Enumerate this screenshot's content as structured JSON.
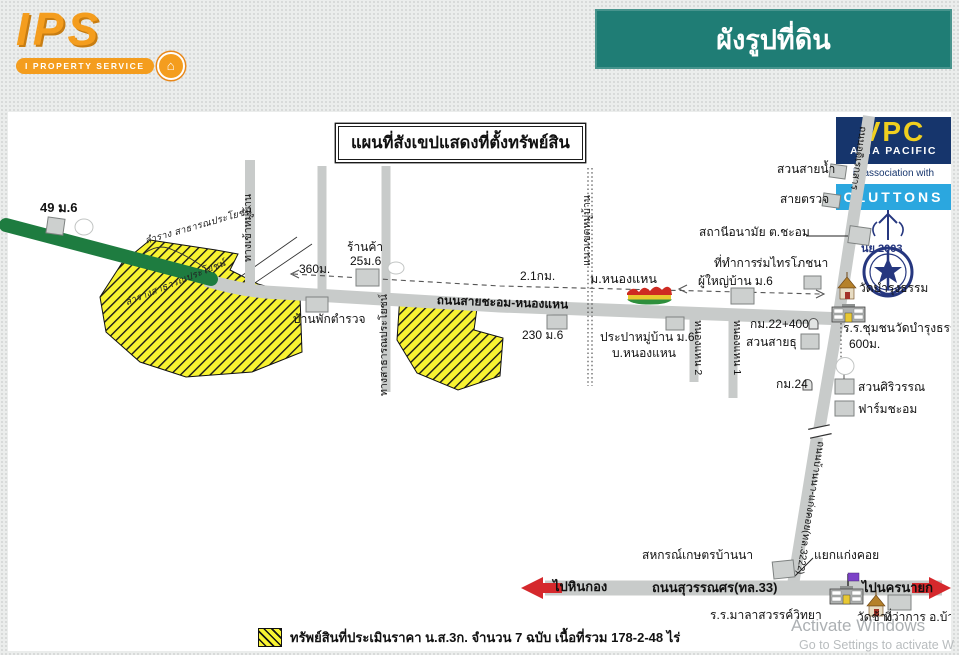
{
  "header": {
    "logo": {
      "brand": "IPS",
      "tagline": "I PROPERTY SERVICE",
      "badge_glyph": "⌂"
    },
    "banner": {
      "title": "ผังรูปที่ดิน",
      "bg": "#1F7D75"
    }
  },
  "vpc": {
    "brand": "VPC",
    "subtitle": "ASIA PACIFIC",
    "association": "in association with",
    "partner": "CLUTTONS"
  },
  "map": {
    "title": "แผนที่สังเขปแสดงที่ตั้งทรัพย์สิน",
    "labels": [
      {
        "text": "49 ม.6",
        "x": 40,
        "y": 201,
        "fs": 13,
        "b": 1,
        "name": "place-label"
      },
      {
        "text": "ลำราง สาธารณประโยชน์",
        "x": 144,
        "y": 237,
        "rot": -16,
        "cls": "hand",
        "name": "ditch-label"
      },
      {
        "text": "ลำรางสาธารณประโยชน์",
        "x": 124,
        "y": 299,
        "rot": -22,
        "cls": "hand",
        "name": "ditch-label"
      },
      {
        "text": "360ม.",
        "x": 299,
        "y": 263,
        "name": "distance-label"
      },
      {
        "text": "ร้านค้า",
        "x": 347,
        "y": 241,
        "name": "place-label"
      },
      {
        "text": "25ม.6",
        "x": 350,
        "y": 255,
        "name": "place-label"
      },
      {
        "text": "บ้านพักตำรวจ",
        "x": 293,
        "y": 313,
        "name": "place-label"
      },
      {
        "text": "2.1กม.",
        "x": 520,
        "y": 270,
        "name": "distance-label"
      },
      {
        "text": "230 ม.6",
        "x": 522,
        "y": 329,
        "name": "place-label"
      },
      {
        "text": "ม.หนองแหน",
        "x": 590,
        "y": 272,
        "fs": 12.5,
        "name": "place-label"
      },
      {
        "text": "ประปาหมู่บ้าน ม.6",
        "x": 600,
        "y": 331,
        "name": "place-label"
      },
      {
        "text": "บ.หนองแหน",
        "x": 612,
        "y": 347,
        "name": "place-label"
      },
      {
        "text": "สวนสายน้ำ",
        "x": 777,
        "y": 163,
        "name": "place-label"
      },
      {
        "text": "สายตรวจ",
        "x": 780,
        "y": 193,
        "name": "place-label"
      },
      {
        "text": "สถานีอนามัย ต.ชะอม",
        "x": 699,
        "y": 226,
        "name": "place-label"
      },
      {
        "text": "ที่ทำการ",
        "x": 714,
        "y": 257,
        "name": "place-label"
      },
      {
        "text": "ผู้ใหญ่บ้าน ม.6",
        "x": 698,
        "y": 275,
        "name": "place-label"
      },
      {
        "text": "ร่มไทรโภชนา",
        "x": 756,
        "y": 257,
        "name": "place-label"
      },
      {
        "text": "นย 2003",
        "x": 861,
        "y": 243,
        "fs": 11,
        "b": 1,
        "c": "#26377F",
        "name": "emblem-label"
      },
      {
        "text": "วัดบำรุงธรรม",
        "x": 859,
        "y": 282,
        "name": "place-label"
      },
      {
        "text": "กม.22+400",
        "x": 750,
        "y": 318,
        "name": "distance-label"
      },
      {
        "text": "สวนสายธุ",
        "x": 746,
        "y": 336,
        "name": "place-label"
      },
      {
        "text": "ร.ร.ชุมชนวัดบำรุงธรรม",
        "x": 843,
        "y": 322,
        "name": "place-label"
      },
      {
        "text": "600ม.",
        "x": 849,
        "y": 338,
        "name": "distance-label"
      },
      {
        "text": "กม.24",
        "x": 776,
        "y": 378,
        "name": "distance-label"
      },
      {
        "text": "สวนศิริวรรณ",
        "x": 858,
        "y": 381,
        "name": "place-label"
      },
      {
        "text": "ฟาร์มชะอม",
        "x": 858,
        "y": 403,
        "name": "place-label"
      },
      {
        "text": "สหกรณ์เกษตรบ้านนา",
        "x": 642,
        "y": 549,
        "name": "place-label"
      },
      {
        "text": "แยกแก่งคอย",
        "x": 814,
        "y": 549,
        "name": "place-label"
      },
      {
        "text": "ไปหินกอง",
        "x": 553,
        "y": 580,
        "fs": 13,
        "b": 1,
        "name": "direction-label"
      },
      {
        "text": "ถนนสุวรรณศร(ทล.33)",
        "x": 652,
        "y": 581,
        "fs": 13,
        "b": 1,
        "name": "road-label"
      },
      {
        "text": "ไปนครนายก",
        "x": 862,
        "y": 581,
        "fs": 13,
        "b": 1,
        "name": "direction-label"
      },
      {
        "text": "ร.ร.มาลาสวรรค์วิทยา",
        "x": 710,
        "y": 609,
        "name": "place-label"
      },
      {
        "text": "วัดช้าง",
        "x": 857,
        "y": 611,
        "name": "place-label"
      },
      {
        "text": "ที่ว่าการ อ.บ้านนา",
        "x": 884,
        "y": 611,
        "name": "place-label"
      },
      {
        "text": "ถนนสายชะอม-หนองแหน",
        "x": 437,
        "y": 294,
        "b": 1,
        "rot": 2,
        "name": "road-label"
      },
      {
        "text": "ทางเข้าหมู่บ้าน",
        "x": 243,
        "y": 262,
        "fs": 10.5,
        "rot": -90,
        "name": "road-label"
      },
      {
        "text": "ทางสาธารณประโยชน์",
        "x": 379,
        "y": 396,
        "fs": 10.5,
        "rot": -90,
        "name": "road-label"
      },
      {
        "text": "แนวเขตหมู่บ้าน",
        "x": 582,
        "y": 266,
        "fs": 10.5,
        "rot": -90,
        "name": "boundary-label"
      },
      {
        "text": "หนองแหน 2",
        "x": 703,
        "y": 320,
        "fs": 10.5,
        "rot": 90,
        "name": "road-label"
      },
      {
        "text": "หนองแหน 1",
        "x": 742,
        "y": 320,
        "fs": 10.5,
        "rot": 90,
        "name": "road-label"
      },
      {
        "text": "ถนนอดิเรกสาร",
        "x": 868,
        "y": 127,
        "fs": 10,
        "rot": 98,
        "name": "road-label"
      },
      {
        "text": "ถนนบ้านนา-แก่งคอย(ทล.3222)",
        "x": 826,
        "y": 442,
        "fs": 10,
        "rot": 99,
        "name": "road-label"
      }
    ]
  },
  "legend": {
    "text": "ทรัพย์สินที่ประเมินราคา น.ส.3ก. จำนวน 7 ฉบับ เนื้อที่รวม 178-2-48 ไร่"
  },
  "watermark": {
    "line1": "Activate Windows",
    "line2": "Go to Settings to activate W"
  },
  "colors": {
    "teal": "#1F7D75",
    "orange": "#F49D1E",
    "road_gray": "#C8CBCA",
    "green_road": "#1E7C40",
    "parcel_yellow": "#F8F332",
    "vpc_navy": "#16356C",
    "vpc_cyan": "#2BA7DF",
    "vpc_yellow": "#F0CF1F",
    "arrow_red": "#D5282C",
    "emblem_navy": "#26377F"
  }
}
